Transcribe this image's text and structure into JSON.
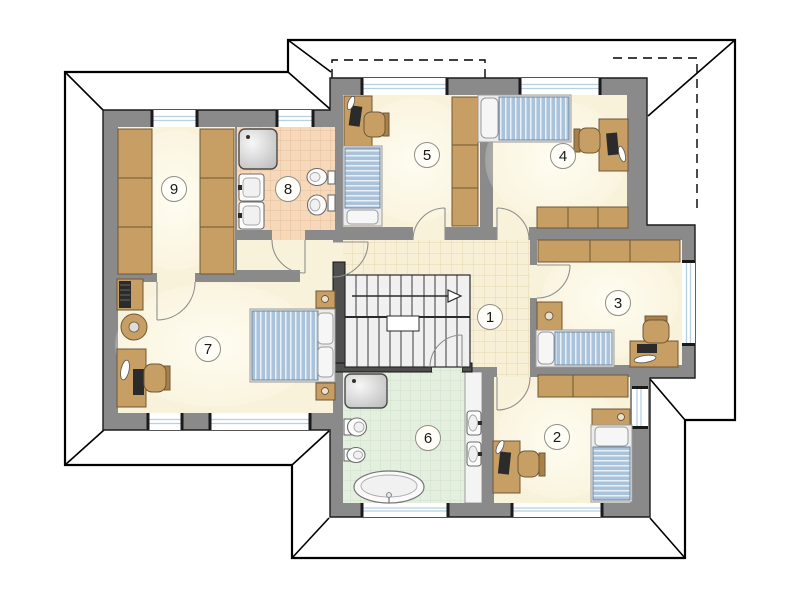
{
  "plan": {
    "kind": "house-upper-floor-plan",
    "rooms": [
      {
        "number": "1",
        "area": "hall-landing",
        "furniture": [
          "staircase",
          "tiled-floor"
        ]
      },
      {
        "number": "2",
        "area": "bedroom",
        "furniture": [
          "single-bed",
          "wardrobe",
          "shelf",
          "desk",
          "office-chair"
        ]
      },
      {
        "number": "3",
        "area": "bedroom",
        "furniture": [
          "single-bed",
          "nightstand",
          "wardrobe",
          "desk",
          "office-chair"
        ]
      },
      {
        "number": "4",
        "area": "bedroom",
        "furniture": [
          "single-bed",
          "wardrobe",
          "desk",
          "office-chair"
        ]
      },
      {
        "number": "5",
        "area": "bedroom",
        "furniture": [
          "single-bed",
          "wardrobe",
          "desk",
          "office-chair"
        ]
      },
      {
        "number": "6",
        "area": "bathroom",
        "furniture": [
          "bathtub",
          "shower",
          "toilet",
          "bidet",
          "double-washbasin"
        ]
      },
      {
        "number": "7",
        "area": "master-bedroom",
        "furniture": [
          "double-bed",
          "nightstand",
          "nightstand",
          "desk",
          "office-chair",
          "tv-cabinet",
          "round-chair"
        ]
      },
      {
        "number": "8",
        "area": "bathroom",
        "furniture": [
          "shower",
          "washbasin",
          "washbasin",
          "toilet",
          "bidet"
        ]
      },
      {
        "number": "9",
        "area": "walk-in-closet",
        "furniture": [
          "wardrobe",
          "wardrobe"
        ]
      }
    ],
    "colors": {
      "wall": "#8a8a8a",
      "stair_wall": "#4f4f4f",
      "floor_cream": "#f9f2da",
      "hall_tile": "#f8f0d6",
      "bath_tile_orange": "#f6d8ba",
      "bath_tile_green": "#e4efe0",
      "furniture_wood": "#c79e63",
      "bed_blue": "#a9c3da",
      "window_glass": "#b7d0e2",
      "roof_line": "#000000"
    }
  }
}
